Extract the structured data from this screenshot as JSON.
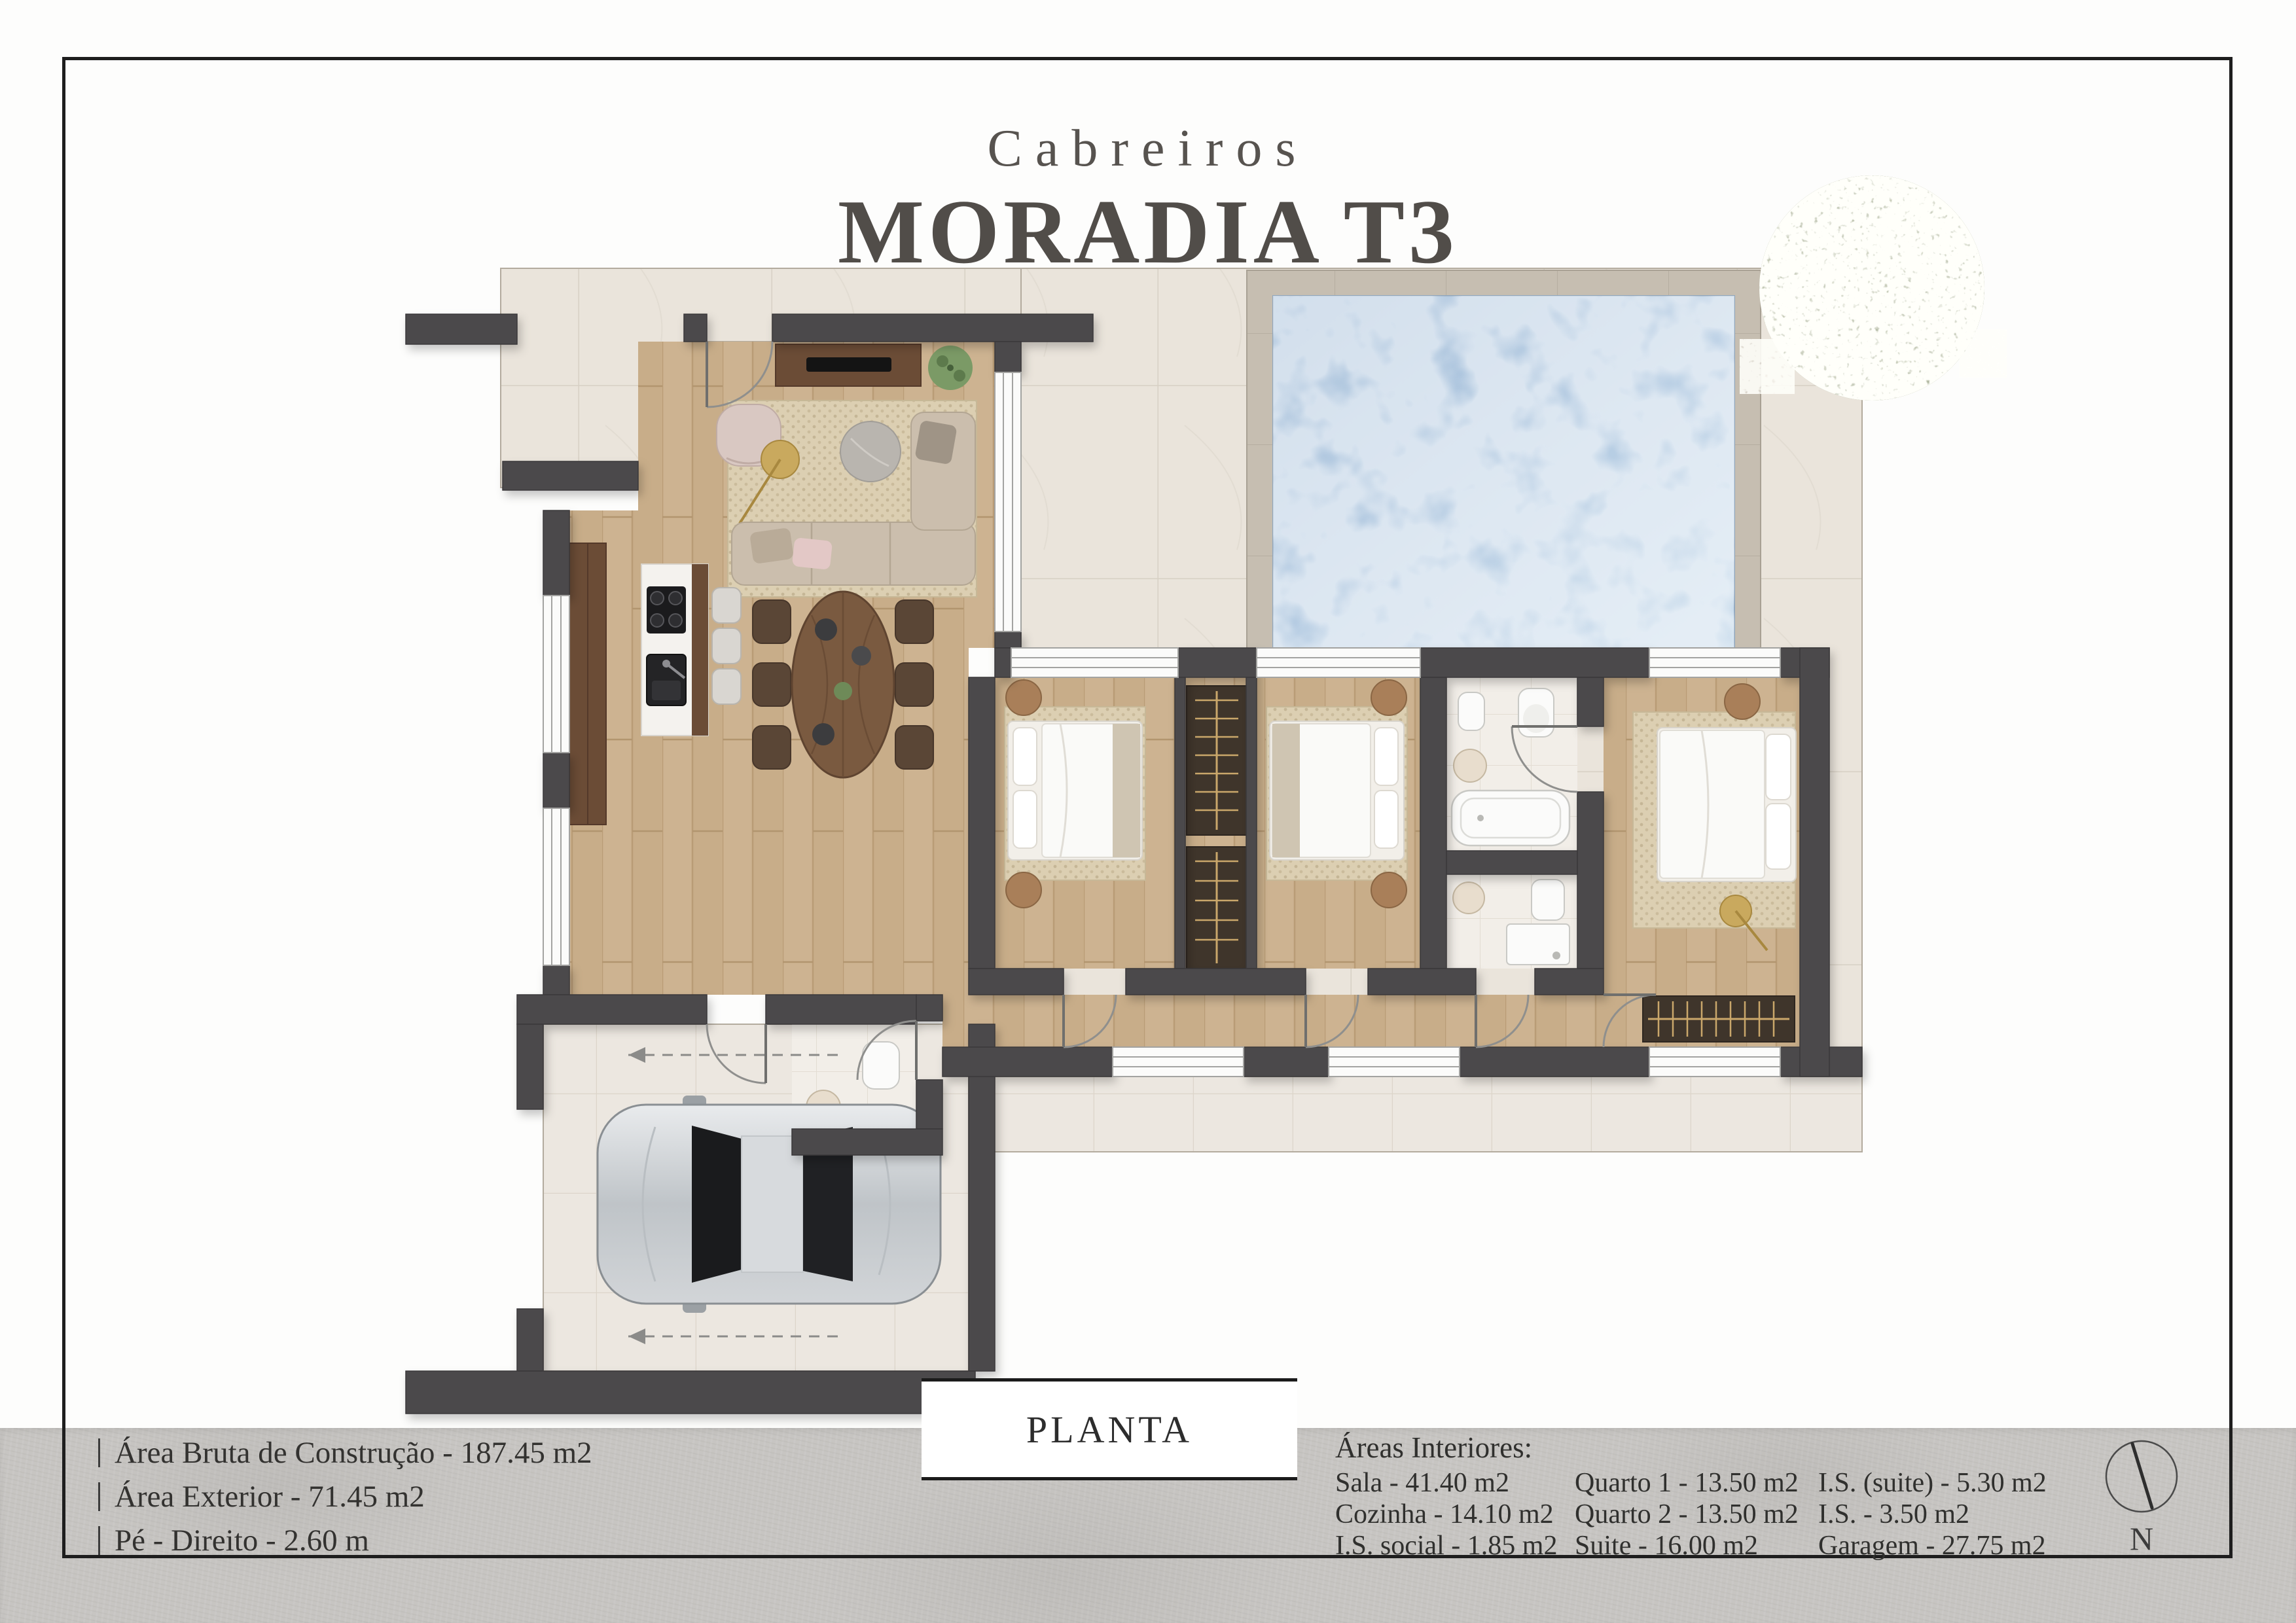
{
  "title": {
    "brand": "Cabreiros",
    "name": "MORADIA T3"
  },
  "plan": {
    "label": "PLANTA",
    "compass_label": "N"
  },
  "footer": {
    "left": [
      "Área Bruta de Construção - 187.45 m2",
      "Área Exterior - 71.45 m2",
      "Pé - Direito - 2.60 m"
    ],
    "areas_header": "Áreas Interiores:",
    "areas_col1": [
      "Sala - 41.40 m2",
      "Cozinha - 14.10 m2",
      "I.S. social - 1.85 m2"
    ],
    "areas_col2": [
      "Quarto 1 - 13.50 m2",
      "Quarto 2 - 13.50 m2",
      "Suite - 16.00 m2"
    ],
    "areas_col3": [
      "I.S. (suite) - 5.30 m2",
      "I.S. - 3.50 m2",
      "Garagem - 27.75 m2"
    ]
  },
  "colors": {
    "wall": "#4b4a4c",
    "wood_floor": "#cdb391",
    "exterior_tile": "#eae4db",
    "pool_water": "#a9c4dc",
    "pool_deck": "#c6beb1",
    "rug": "#dccfb2",
    "accent_gold": "#c9a95e",
    "ink": "#3b3835",
    "footer_band": "#c7c5c2"
  }
}
